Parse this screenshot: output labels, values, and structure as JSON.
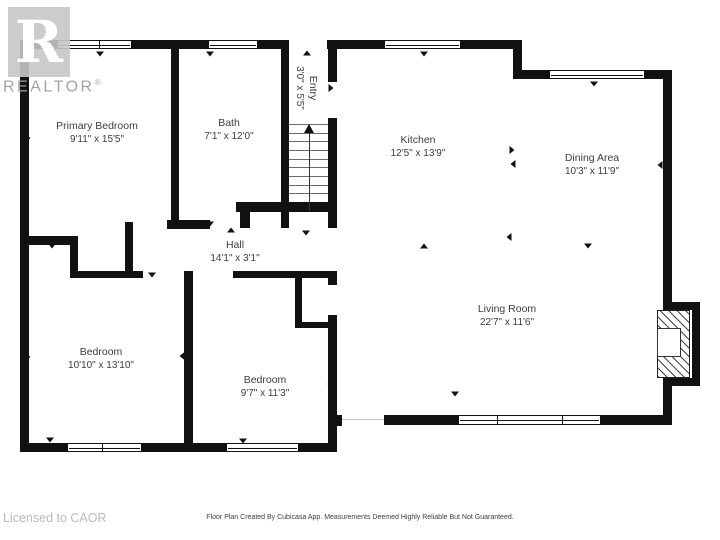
{
  "branding": {
    "logo_letter": "R",
    "logo_wordmark": "REALTOR",
    "logo_reg": "®"
  },
  "footer": {
    "disclaimer": "Floor Plan Created By Cubicasa App. Measurements Deemed Highly Reliable But Not Guaranteed.",
    "license": "Licensed to CAOR"
  },
  "colors": {
    "wall": "#111111",
    "room_text": "#3d3d3d",
    "logo_gray": "#c6c6c6",
    "wordmark_gray": "#a3a3a3",
    "license_gray": "#b5bcc1"
  },
  "rooms": [
    {
      "name": "Primary Bedroom",
      "dims": "9'11\" x 15'5\"",
      "cx": 97,
      "cy": 133,
      "rotated": false
    },
    {
      "name": "Bath",
      "dims": "7'1\" x 12'0\"",
      "cx": 229,
      "cy": 130,
      "rotated": false
    },
    {
      "name": "Entry",
      "dims": "3'0\" x 5'5\"",
      "cx": 306,
      "cy": 88,
      "rotated": true
    },
    {
      "name": "Kitchen",
      "dims": "12'5\" x 13'9\"",
      "cx": 418,
      "cy": 147,
      "rotated": false
    },
    {
      "name": "Dining Area",
      "dims": "10'3\" x 11'9\"",
      "cx": 592,
      "cy": 165,
      "rotated": false
    },
    {
      "name": "Hall",
      "dims": "14'1\" x 3'1\"",
      "cx": 235,
      "cy": 252,
      "rotated": false
    },
    {
      "name": "Bedroom",
      "dims": "10'10\" x 13'10\"",
      "cx": 101,
      "cy": 359,
      "rotated": false
    },
    {
      "name": "Bedroom",
      "dims": "9'7\" x 11'3\"",
      "cx": 265,
      "cy": 387,
      "rotated": false
    },
    {
      "name": "Living Room",
      "dims": "22'7\" x 11'6\"",
      "cx": 507,
      "cy": 316,
      "rotated": false
    }
  ],
  "plan": {
    "walls": [
      {
        "x": 20,
        "y": 40,
        "w": 9,
        "h": 412
      },
      {
        "x": 29,
        "y": 40,
        "w": 28,
        "h": 9
      },
      {
        "x": 132,
        "y": 40,
        "w": 76,
        "h": 9
      },
      {
        "x": 258,
        "y": 40,
        "w": 31,
        "h": 9
      },
      {
        "x": 327,
        "y": 40,
        "w": 57,
        "h": 9
      },
      {
        "x": 461,
        "y": 40,
        "w": 61,
        "h": 9
      },
      {
        "x": 513,
        "y": 40,
        "w": 9,
        "h": 39
      },
      {
        "x": 522,
        "y": 70,
        "w": 27,
        "h": 9
      },
      {
        "x": 645,
        "y": 70,
        "w": 27,
        "h": 9
      },
      {
        "x": 663,
        "y": 70,
        "w": 9,
        "h": 240
      },
      {
        "x": 663,
        "y": 302,
        "w": 37,
        "h": 8
      },
      {
        "x": 692,
        "y": 302,
        "w": 8,
        "h": 84
      },
      {
        "x": 663,
        "y": 378,
        "w": 37,
        "h": 8
      },
      {
        "x": 663,
        "y": 378,
        "w": 9,
        "h": 47
      },
      {
        "x": 384,
        "y": 415,
        "w": 74,
        "h": 10
      },
      {
        "x": 601,
        "y": 415,
        "w": 71,
        "h": 10
      },
      {
        "x": 328,
        "y": 415,
        "w": 14,
        "h": 11
      },
      {
        "x": 328,
        "y": 327,
        "w": 9,
        "h": 125
      },
      {
        "x": 20,
        "y": 443,
        "w": 47,
        "h": 9
      },
      {
        "x": 142,
        "y": 443,
        "w": 84,
        "h": 9
      },
      {
        "x": 299,
        "y": 443,
        "w": 38,
        "h": 9
      },
      {
        "x": 171,
        "y": 49,
        "w": 8,
        "h": 171
      },
      {
        "x": 167,
        "y": 220,
        "w": 43,
        "h": 9
      },
      {
        "x": 281,
        "y": 49,
        "w": 8,
        "h": 163
      },
      {
        "x": 328,
        "y": 49,
        "w": 9,
        "h": 33
      },
      {
        "x": 328,
        "y": 118,
        "w": 9,
        "h": 94
      },
      {
        "x": 236,
        "y": 202,
        "w": 101,
        "h": 10
      },
      {
        "x": 240,
        "y": 212,
        "w": 10,
        "h": 16
      },
      {
        "x": 281,
        "y": 212,
        "w": 8,
        "h": 16
      },
      {
        "x": 328,
        "y": 212,
        "w": 9,
        "h": 16
      },
      {
        "x": 125,
        "y": 222,
        "w": 8,
        "h": 50
      },
      {
        "x": 29,
        "y": 236,
        "w": 49,
        "h": 9
      },
      {
        "x": 70,
        "y": 245,
        "w": 8,
        "h": 33
      },
      {
        "x": 70,
        "y": 271,
        "w": 73,
        "h": 7
      },
      {
        "x": 233,
        "y": 271,
        "w": 104,
        "h": 7
      },
      {
        "x": 184,
        "y": 271,
        "w": 9,
        "h": 172
      },
      {
        "x": 295,
        "y": 278,
        "w": 7,
        "h": 50
      },
      {
        "x": 295,
        "y": 322,
        "w": 42,
        "h": 6
      },
      {
        "x": 328,
        "y": 271,
        "w": 9,
        "h": 14
      },
      {
        "x": 328,
        "y": 315,
        "w": 9,
        "h": 12
      }
    ],
    "windows": [
      {
        "x": 57,
        "y": 40,
        "w": 75,
        "h": 9,
        "mullions": [
          0.56
        ]
      },
      {
        "x": 208,
        "y": 40,
        "w": 50,
        "h": 9,
        "mullions": []
      },
      {
        "x": 384,
        "y": 40,
        "w": 77,
        "h": 9,
        "mullions": []
      },
      {
        "x": 549,
        "y": 70,
        "w": 96,
        "h": 9,
        "mullions": []
      },
      {
        "x": 458,
        "y": 415,
        "w": 143,
        "h": 10,
        "mullions": [
          0.27,
          0.73
        ]
      },
      {
        "x": 67,
        "y": 443,
        "w": 75,
        "h": 9,
        "mullions": [
          0.47
        ]
      },
      {
        "x": 226,
        "y": 443,
        "w": 73,
        "h": 9,
        "mullions": []
      }
    ],
    "opening": {
      "x": 342,
      "y": 419,
      "w": 42,
      "h": 1
    },
    "stairs": {
      "x": 289,
      "y": 124,
      "w": 39,
      "h": 78,
      "treads": 9
    },
    "fireplace": {
      "hx": 657,
      "hy": 310,
      "hw": 33,
      "hh": 68,
      "fx": 657,
      "fy": 328,
      "fw": 24,
      "fh": 29
    },
    "markers": [
      {
        "x": 100,
        "y": 54,
        "dir": "down"
      },
      {
        "x": 210,
        "y": 54,
        "dir": "down"
      },
      {
        "x": 307,
        "y": 53,
        "dir": "up"
      },
      {
        "x": 424,
        "y": 54,
        "dir": "down"
      },
      {
        "x": 594,
        "y": 84,
        "dir": "down"
      },
      {
        "x": 660,
        "y": 165,
        "dir": "left"
      },
      {
        "x": 28,
        "y": 138,
        "dir": "right"
      },
      {
        "x": 28,
        "y": 357,
        "dir": "right"
      },
      {
        "x": 512,
        "y": 150,
        "dir": "right"
      },
      {
        "x": 513,
        "y": 164,
        "dir": "left"
      },
      {
        "x": 424,
        "y": 246,
        "dir": "up"
      },
      {
        "x": 509,
        "y": 237,
        "dir": "left"
      },
      {
        "x": 588,
        "y": 246,
        "dir": "down"
      },
      {
        "x": 210,
        "y": 224,
        "dir": "down"
      },
      {
        "x": 231,
        "y": 230,
        "dir": "up"
      },
      {
        "x": 306,
        "y": 233,
        "dir": "down"
      },
      {
        "x": 52,
        "y": 246,
        "dir": "down"
      },
      {
        "x": 152,
        "y": 275,
        "dir": "down"
      },
      {
        "x": 182,
        "y": 356,
        "dir": "left"
      },
      {
        "x": 189,
        "y": 383,
        "dir": "right"
      },
      {
        "x": 330,
        "y": 384,
        "dir": "left"
      },
      {
        "x": 455,
        "y": 394,
        "dir": "down"
      },
      {
        "x": 50,
        "y": 440,
        "dir": "down"
      },
      {
        "x": 243,
        "y": 441,
        "dir": "down"
      },
      {
        "x": 285,
        "y": 88,
        "dir": "left"
      },
      {
        "x": 331,
        "y": 88,
        "dir": "right"
      }
    ]
  }
}
